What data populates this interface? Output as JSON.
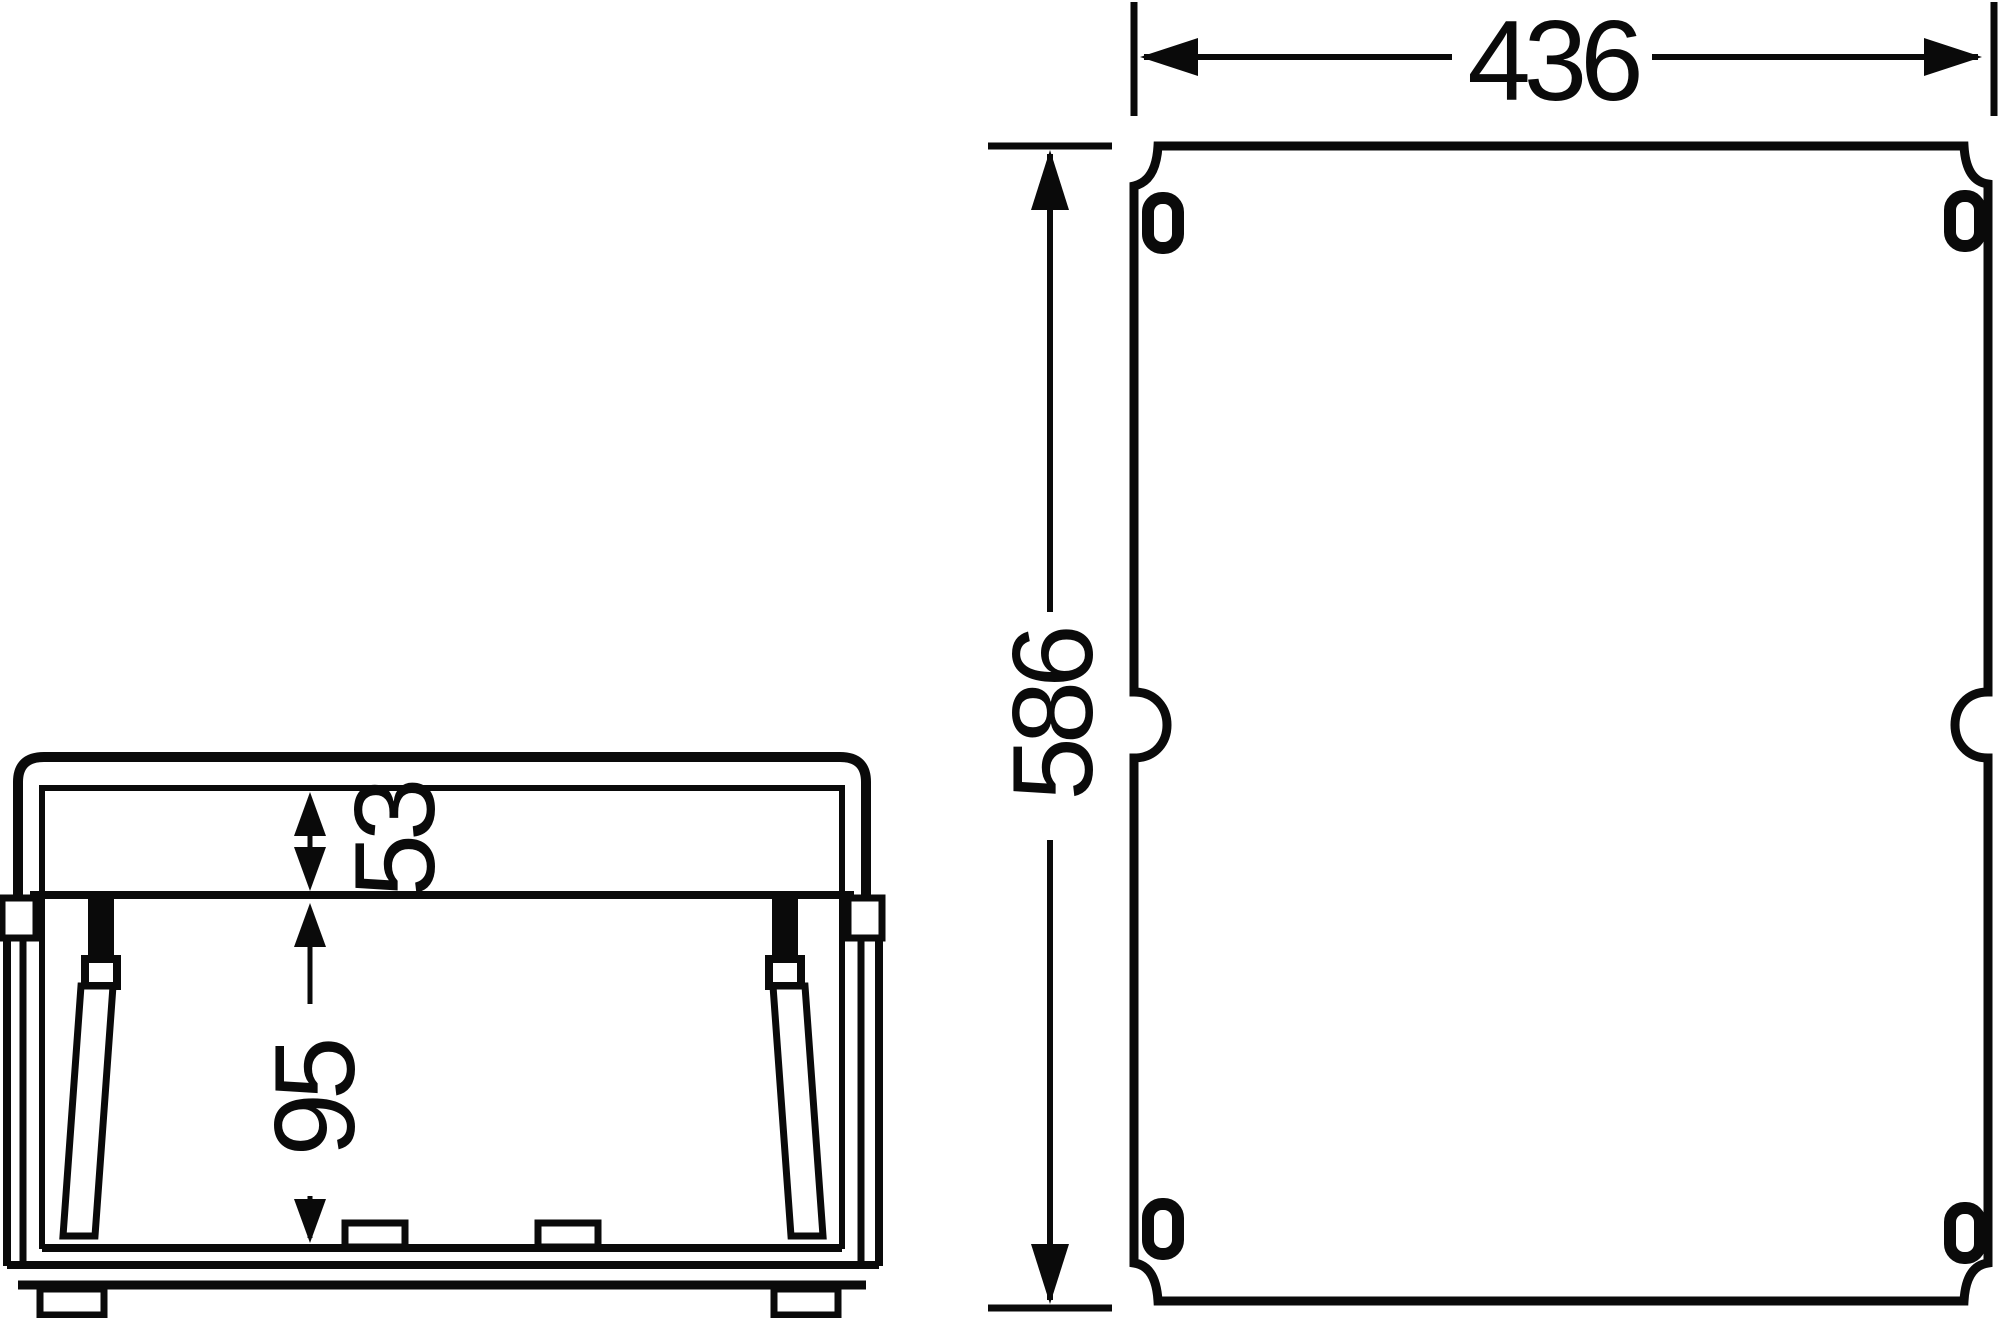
{
  "drawing": {
    "type": "technical-dimension-drawing",
    "views": {
      "side": {
        "name": "enclosure side view",
        "cover_depth_label": "53",
        "base_depth_label": "95"
      },
      "front": {
        "name": "enclosure cover front view",
        "width_label": "436",
        "height_label": "586"
      }
    }
  },
  "colors": {
    "line": "#0a0a0a",
    "background": "#ffffff"
  }
}
